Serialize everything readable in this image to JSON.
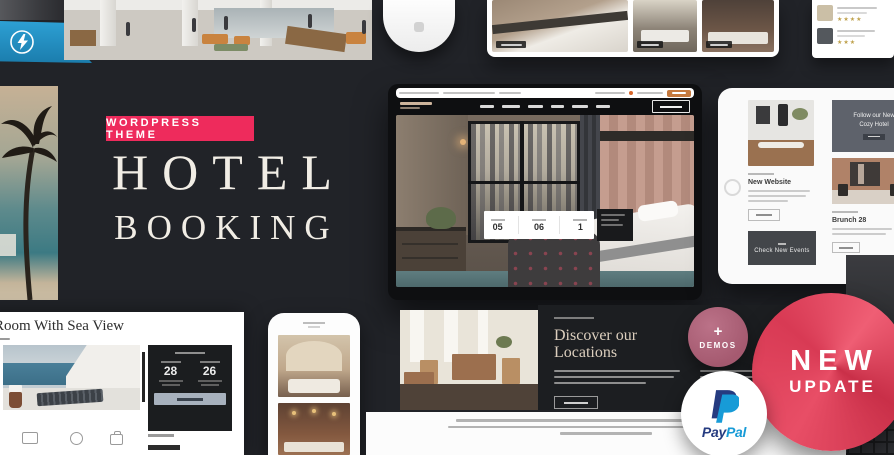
{
  "theme": {
    "badge": "WORDPRESS THEME",
    "title_line1": "HOTEL",
    "title_line2": "BOOKING"
  },
  "hero_site": {
    "booking": {
      "check_in": "05",
      "check_out": "06",
      "guests": "1"
    }
  },
  "tablet": {
    "post_new_website": "New Website",
    "events_card": "Check New Events",
    "promo_line1": "Follow our New",
    "promo_line2": "Cozy Hotel",
    "post_brunch": "Brunch 28"
  },
  "room_page": {
    "title": "Room With Sea View",
    "check_in_day": "28",
    "check_out_day": "26"
  },
  "locations": {
    "heading_line1": "Discover our",
    "heading_line2": "Locations"
  },
  "stickers": {
    "new_line1": "NEW",
    "new_line2": "UPDATE",
    "demos_plus": "+",
    "demos_label": "DEMOS",
    "paypal_pay": "Pay",
    "paypal_pal": "Pal"
  },
  "colors": {
    "accent_pink": "#ee2b5c",
    "sticker_red": "#d83a54",
    "sticker_mauve": "#a55a70",
    "ribbon_blue": "#2193c6",
    "paypal_dark": "#253b80",
    "paypal_light": "#179bd7"
  }
}
